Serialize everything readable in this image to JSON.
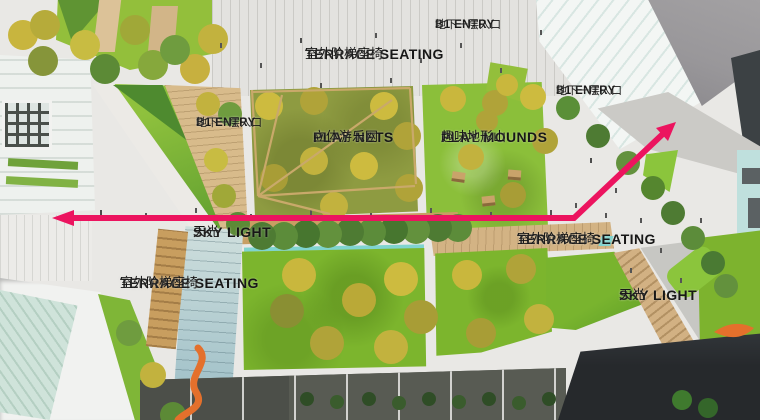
{
  "title": "Annotated aerial landscape masterplan rendering",
  "colors": {
    "arrow": "#ec145f",
    "label_text": "#171717",
    "lawn_bright": "#7cb52d",
    "lawn_olive": "#8e9b41",
    "sand": "#d8bb8b",
    "paving_light": "#e9e8e5",
    "paving_dark": "#585b53",
    "roof_gray": "#99979a",
    "glass_teal": "#bfe0dd",
    "tree_yellow": "#c9b73d",
    "tree_green": "#55842f",
    "sculpture_orange": "#e4702c"
  },
  "labels": [
    {
      "id": "terrace-seating-top",
      "en": "TERRACE SEATING",
      "zh": "室外阶梯座椅"
    },
    {
      "id": "b1-entry-top",
      "en": "B1 ENTRY",
      "zh": "地下一层入口"
    },
    {
      "id": "b1-entry-left",
      "en": "B1 ENTRY",
      "zh": "地下一层入口"
    },
    {
      "id": "play-nets",
      "en": "PLAY NETS",
      "zh": "立体游乐网"
    },
    {
      "id": "play-mounds",
      "en": "PLAY MOUNDS",
      "zh": "趣味地形山"
    },
    {
      "id": "b1-entry-right",
      "en": "B1 ENTRY",
      "zh": "地下一层入口"
    },
    {
      "id": "sky-light-left",
      "en": "SKY LIGHT",
      "zh": "天光"
    },
    {
      "id": "terrace-seating-mid",
      "en": "TERRACE SEATING",
      "zh": "室外阶梯座椅"
    },
    {
      "id": "terrace-seating-bottom",
      "en": "TERRACE SEATING",
      "zh": "室外阶梯座椅"
    },
    {
      "id": "sky-light-right",
      "en": "SKY LIGHT",
      "zh": "天光"
    }
  ],
  "arrow": {
    "line_points": "72,218 574,218 666,131",
    "head_left": "74,210 74,226 52,218",
    "head_right": "676,122 668,141 656,128"
  },
  "net_lines": {
    "d": "M258,196 L282,95 M258,196 L392,100 M258,196 L415,186 M258,196 L330,214 M258,196 L252,90 M252,92 L410,88 M410,88 L416,184"
  },
  "sculptures": {
    "ribbon_d": "M198,348 C212,362 186,376 196,392 C206,408 184,412 178,420",
    "orange_d": "M714,332 q20,-14 40,-4 q-16,16 -40,4 Z"
  }
}
